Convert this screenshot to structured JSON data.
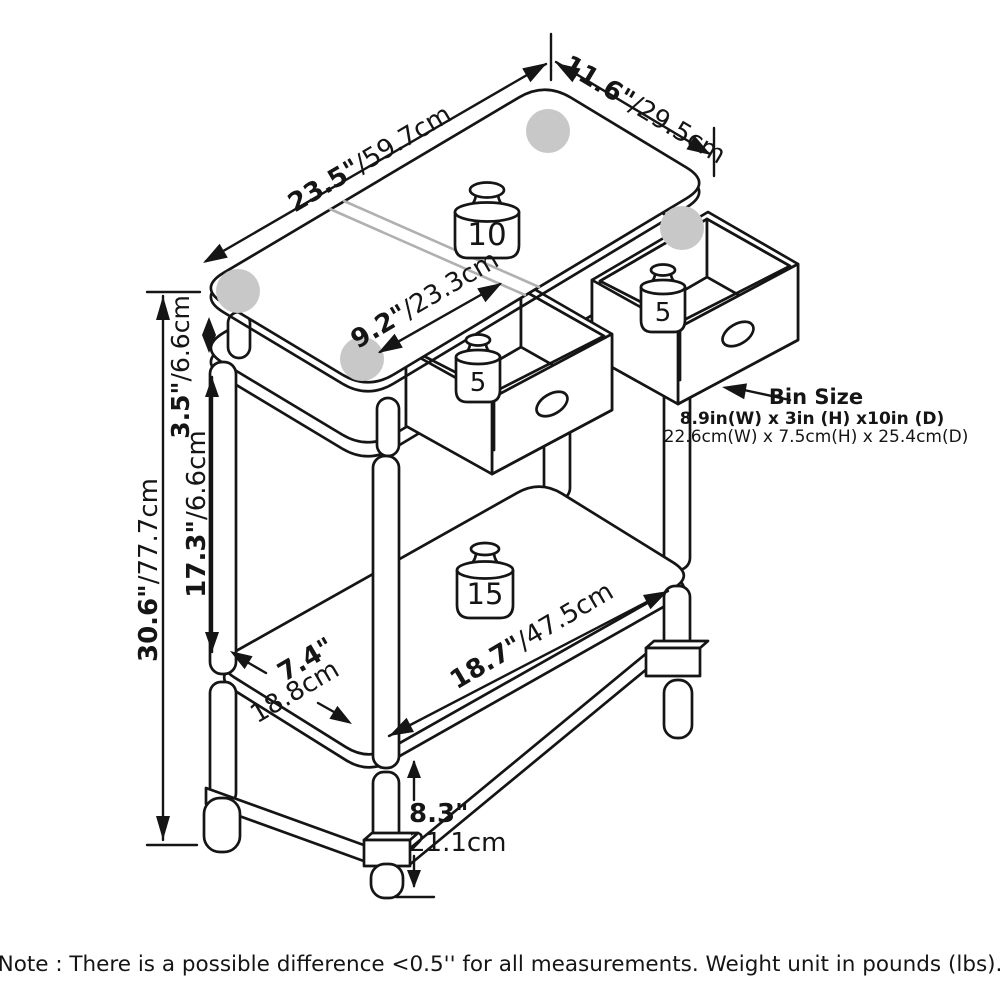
{
  "diagram": {
    "note": "Note : There is a possible difference <0.5'' for all measurements. Weight unit in pounds (lbs).",
    "bin_size": {
      "title": "Bin Size",
      "line_in": "8.9in(W) x 3in (H) x10in (D)",
      "line_cm": "22.6cm(W) x 7.5cm(H) x 25.4cm(D)"
    },
    "dimensions": {
      "top_length": {
        "in": "23.5\"",
        "cm": "/59.7cm"
      },
      "top_depth": {
        "in": "11.6\"",
        "cm": "/29.5cm"
      },
      "top_inner": {
        "in": "9.2\"",
        "cm": "/23.3cm"
      },
      "glass_gap": {
        "in": "3.5\"",
        "cm": "/6.6cm"
      },
      "mid_height": {
        "in": "17.3\"",
        "cm": "/6.6cm"
      },
      "overall_height": {
        "in": "30.6\"",
        "cm": "/77.7cm"
      },
      "shelf_depth": {
        "in": "7.4\"",
        "cm": "18.8cm"
      },
      "shelf_length": {
        "in": "18.7\"",
        "cm": "/47.5cm"
      },
      "shelf_clearance": {
        "in": "8.3\"",
        "cm": "21.1cm"
      }
    },
    "load_ratings": {
      "top": "10",
      "left_bin": "5",
      "right_bin": "5",
      "shelf": "15"
    },
    "colors": {
      "line": "#151515",
      "pad_gray": "#c8c8c8",
      "reflection_gray": "#b0b0b0",
      "background": "#ffffff"
    }
  }
}
